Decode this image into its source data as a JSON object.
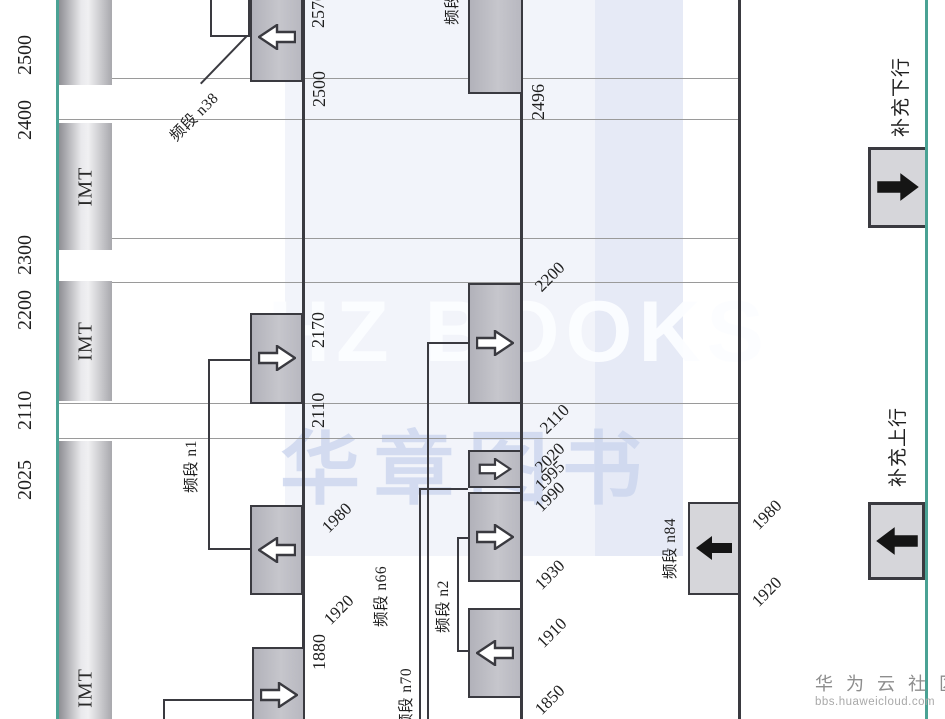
{
  "colors": {
    "accent_green": "#4aa294",
    "box_border": "#3a3a40",
    "box_fill": "#bfbfc6",
    "box_fill_light": "#d6d6da",
    "gridline": "#9a9a9a"
  },
  "top_axis": {
    "imt_label": "IMT",
    "ticks": [
      "2500",
      "2400",
      "2300",
      "2200",
      "2110",
      "2025"
    ]
  },
  "row1": {
    "band_labels": {
      "n38": "频段 n38",
      "n1": "频段 n1"
    },
    "ticks": {
      "t2570": "2570",
      "t2500": "2500",
      "t2170": "2170",
      "t2110": "2110",
      "t1980": "1980",
      "t1920": "1920",
      "t1880": "1880"
    }
  },
  "row2": {
    "band_labels": {
      "n41": "频段 n41",
      "n66": "频段 n66",
      "n70": "频段 n70",
      "n2": "频段 n2"
    },
    "ticks": {
      "t2496": "2496",
      "t2200": "2200",
      "t2110": "2110",
      "t2020": "2020",
      "t1995": "1995",
      "t1990": "1990",
      "t1930": "1930",
      "t1910": "1910",
      "t1850": "1850"
    }
  },
  "row3": {
    "band_labels": {
      "n84": "频段 n84"
    },
    "ticks": {
      "t1980": "1980",
      "t1920": "1920"
    }
  },
  "legend": {
    "supplementary_downlink": "补充下行",
    "supplementary_uplink": "补充上行"
  },
  "watermarks": {
    "hz_books": "HZ BOOKS",
    "hz_books_cn": "华章图书",
    "community": "华 为 云 社 区",
    "site": "bbs.huaweicloud.com"
  }
}
